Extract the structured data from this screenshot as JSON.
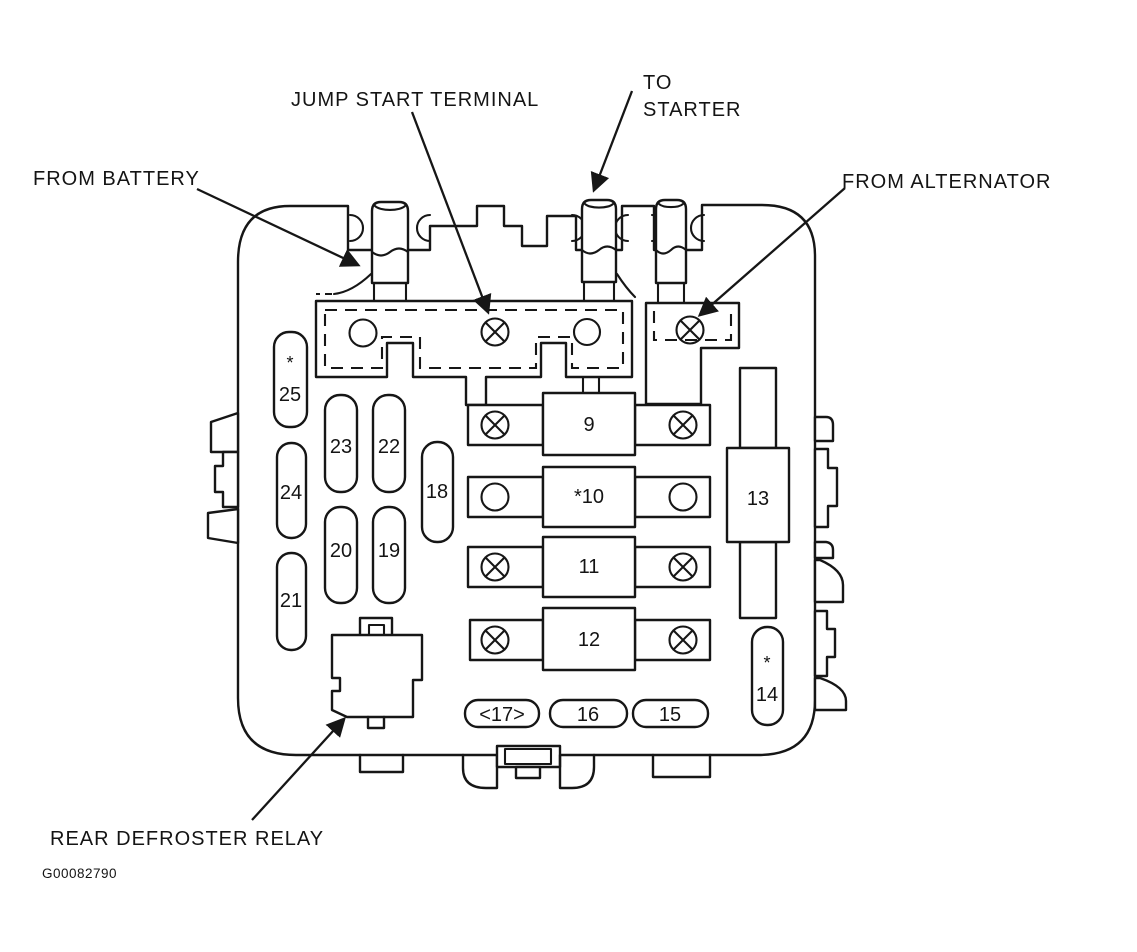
{
  "figure": {
    "id": "G00082790",
    "type": "underhood fuse box line diagram",
    "background_color": "#ffffff",
    "line_color": "#161616"
  },
  "callouts": {
    "jump_start_terminal": "JUMP START TERMINAL",
    "to_starter_line1": "TO",
    "to_starter_line2": "STARTER",
    "from_battery": "FROM BATTERY",
    "from_alternator": "FROM ALTERNATOR",
    "rear_defroster_relay": "REAR DEFROSTER RELAY"
  },
  "fuses": {
    "f9": "9",
    "f10": "*10",
    "f11": "11",
    "f12": "12",
    "f13": "13",
    "f14": "14",
    "f14_star": "*",
    "f15": "15",
    "f16": "16",
    "f17": "<17>",
    "f18": "18",
    "f19": "19",
    "f20": "20",
    "f21": "21",
    "f22": "22",
    "f23": "23",
    "f24": "24",
    "f25": "25",
    "f25_star": "*"
  }
}
